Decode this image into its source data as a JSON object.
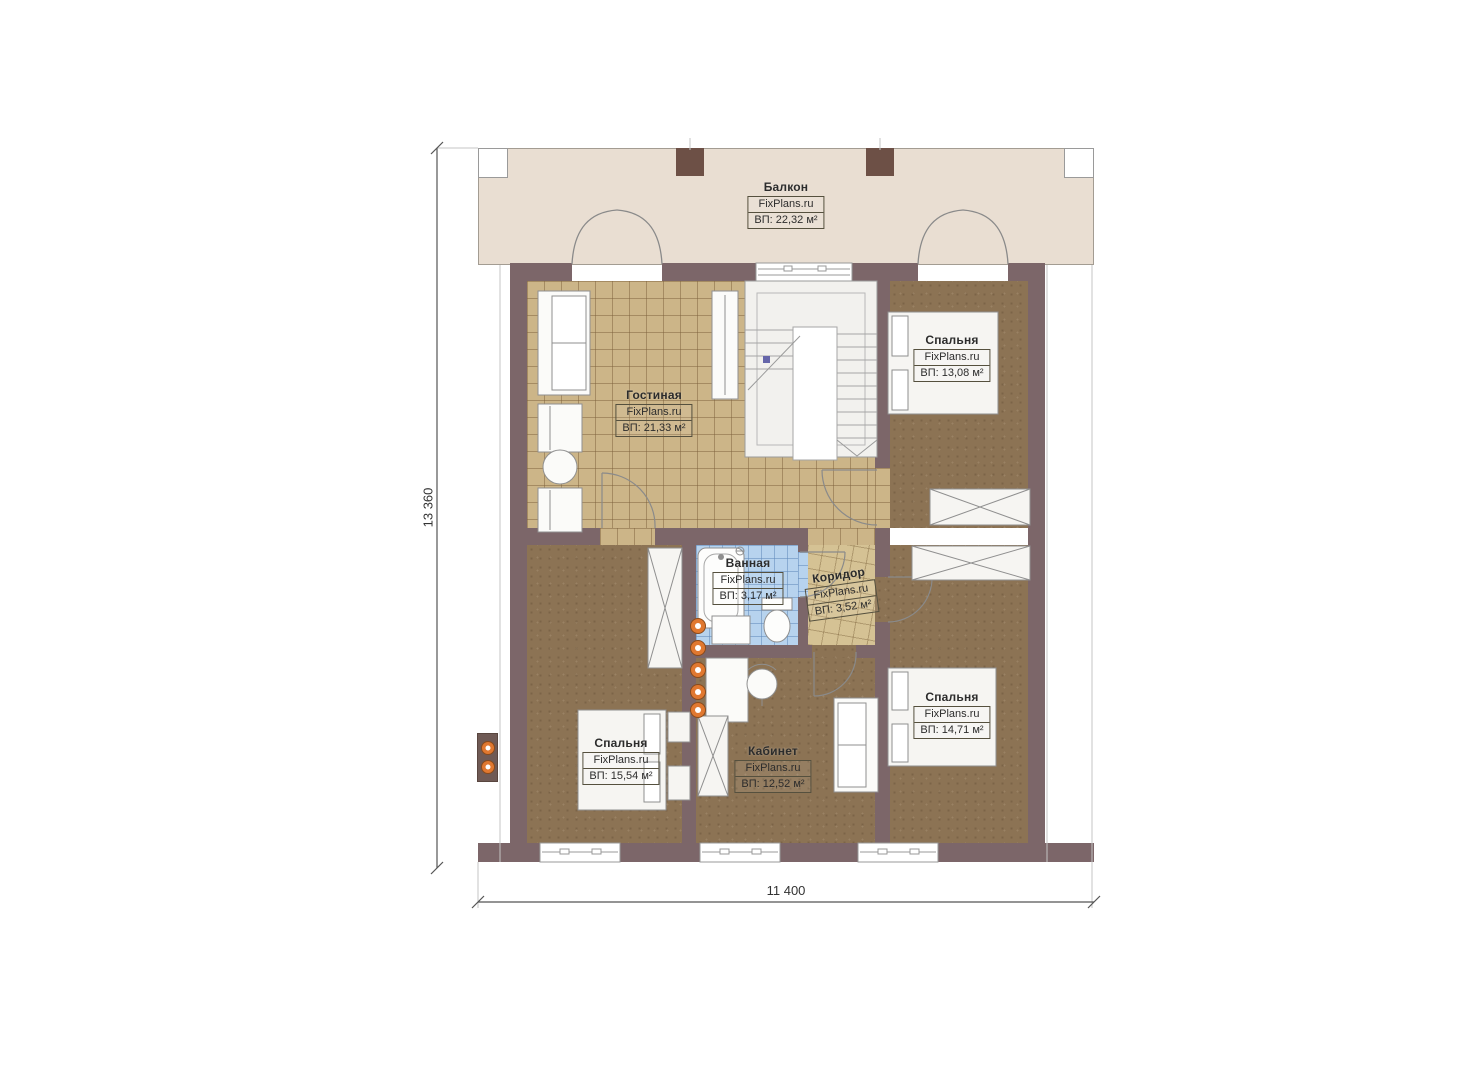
{
  "plan": {
    "brand": "FixPlans.ru",
    "rooms": {
      "balcony": {
        "name": "Балкон",
        "brand": "FixPlans.ru",
        "area": "ВП: 22,32 м²"
      },
      "living": {
        "name": "Гостиная",
        "brand": "FixPlans.ru",
        "area": "ВП: 21,33 м²"
      },
      "bedroom_ne": {
        "name": "Спальня",
        "brand": "FixPlans.ru",
        "area": "ВП: 13,08 м²"
      },
      "bathroom": {
        "name": "Ванная",
        "brand": "FixPlans.ru",
        "area": "ВП: 3,17 м²"
      },
      "corridor": {
        "name": "Коридор",
        "brand": "FixPlans.ru",
        "area": "ВП: 3,52 м²"
      },
      "bedroom_sw": {
        "name": "Спальня",
        "brand": "FixPlans.ru",
        "area": "ВП: 15,54 м²"
      },
      "office": {
        "name": "Кабинет",
        "brand": "FixPlans.ru",
        "area": "ВП: 12,52 м²"
      },
      "bedroom_se": {
        "name": "Спальня",
        "brand": "FixPlans.ru",
        "area": "ВП: 14,71 м²"
      }
    },
    "dimensions": {
      "height_label": "13 360",
      "width_label": "11 400"
    },
    "colors": {
      "wall": "#7c6669",
      "pillar": "#6d5046",
      "tile_floor": "#ccb588",
      "carpet_floor": "#8c7354",
      "bath_tile": "#b7d3ee",
      "corridor_tile": "#d5c294",
      "balcony_floor": "#e9ded2",
      "accent_light_dot": "#e07830"
    }
  }
}
